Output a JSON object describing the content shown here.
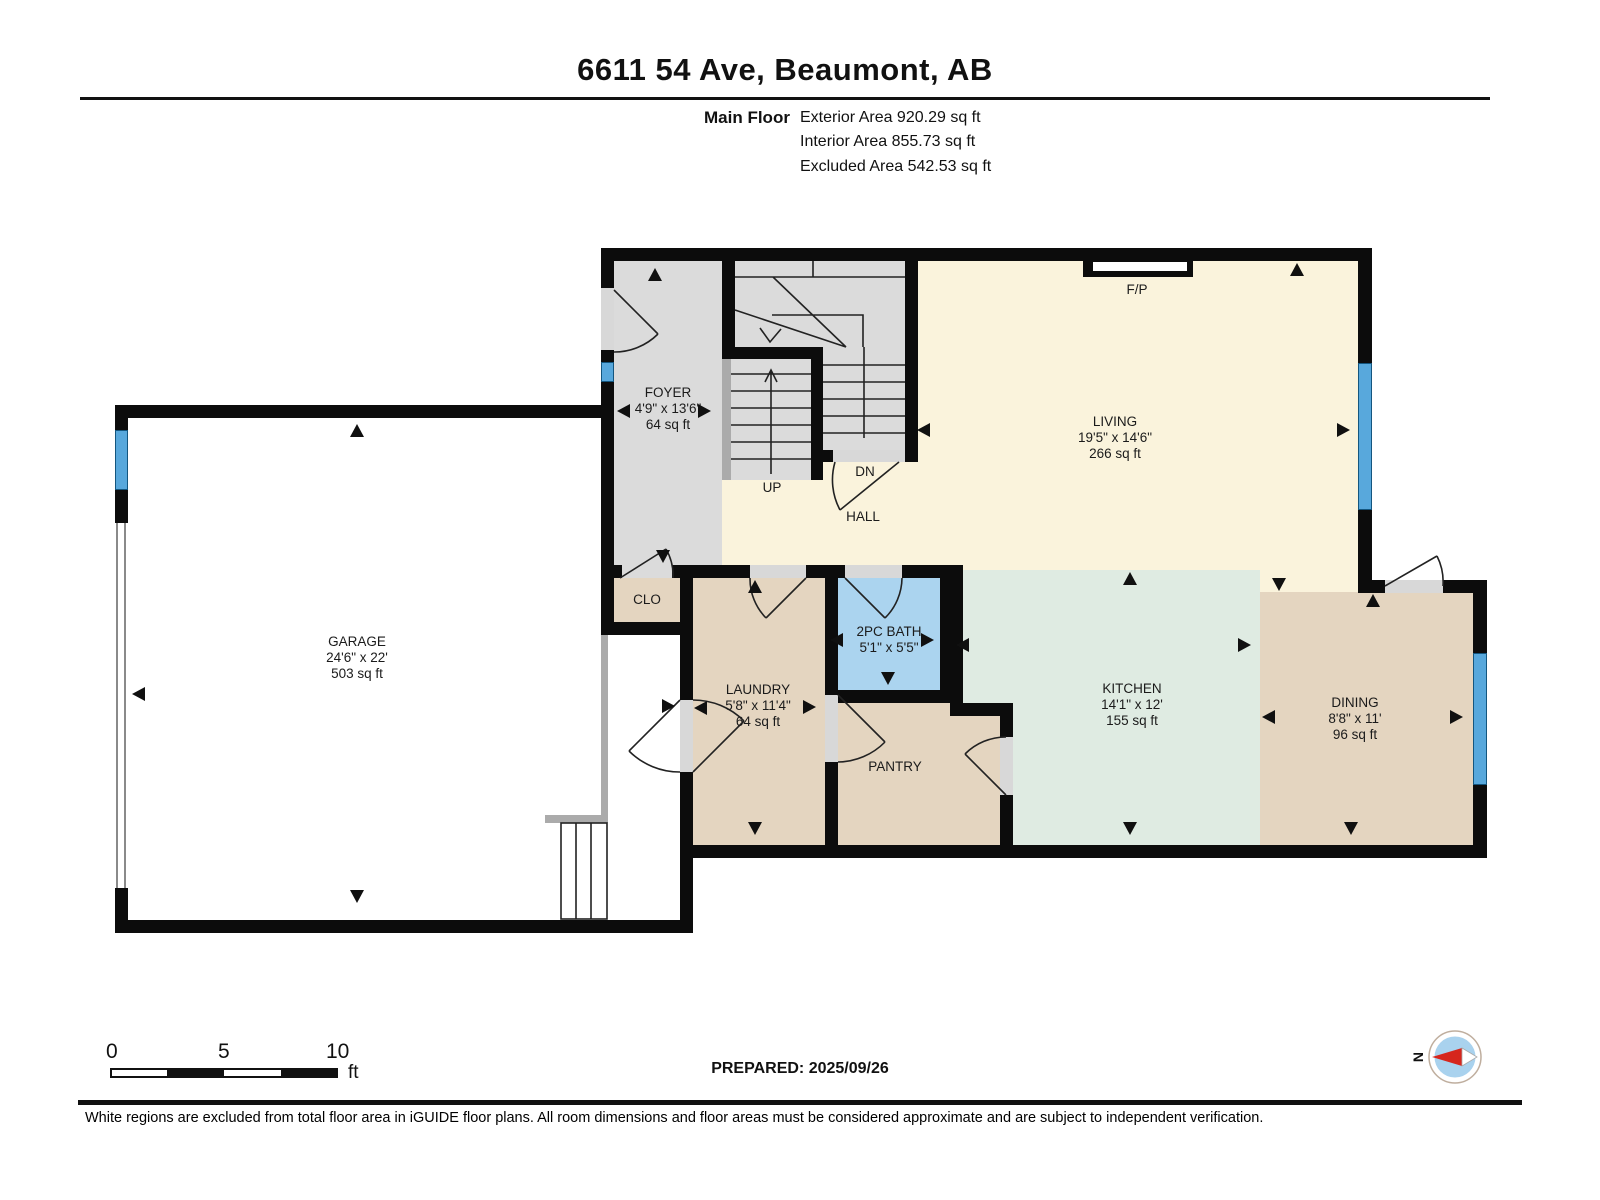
{
  "header": {
    "title": "6611 54 Ave, Beaumont, AB",
    "floor_label": "Main Floor",
    "area_lines": [
      "Exterior Area 920.29 sq ft",
      "Interior Area 855.73 sq ft",
      "Excluded Area 542.53 sq ft"
    ]
  },
  "rooms": {
    "foyer": {
      "name": "FOYER",
      "dims": "4'9\" x 13'6\"",
      "area": "64 sq ft"
    },
    "living": {
      "name": "LIVING",
      "dims": "19'5\" x 14'6\"",
      "area": "266 sq ft"
    },
    "garage": {
      "name": "GARAGE",
      "dims": "24'6\" x 22'",
      "area": "503 sq ft"
    },
    "laundry": {
      "name": "LAUNDRY",
      "dims": "5'8\" x 11'4\"",
      "area": "64 sq ft"
    },
    "bath": {
      "name": "2PC BATH",
      "dims": "5'1\" x 5'5\""
    },
    "kitchen": {
      "name": "KITCHEN",
      "dims": "14'1\" x 12'",
      "area": "155 sq ft"
    },
    "dining": {
      "name": "DINING",
      "dims": "8'8\" x 11'",
      "area": "96 sq ft"
    },
    "pantry": {
      "name": "PANTRY"
    },
    "clo": {
      "name": "CLO"
    },
    "hall": {
      "name": "HALL"
    }
  },
  "stair_labels": {
    "up": "UP",
    "dn": "DN"
  },
  "fireplace_label": "F/P",
  "scale_bar": {
    "ticks": [
      "0",
      "5",
      "10"
    ],
    "unit": "ft"
  },
  "footer": {
    "prepared": "PREPARED: 2025/09/26",
    "compass_label": "N",
    "disclaimer": "White regions are excluded from total floor area in iGUIDE floor plans. All room dimensions and floor areas must be considered approximate and are subject to independent verification."
  },
  "colors": {
    "wall": "#0c0c0c",
    "floor_cream": "#faf3dc",
    "floor_gray": "#dbdbdb",
    "floor_tan": "#e4d5c0",
    "floor_blue": "#abd4ef",
    "floor_mint": "#dfebe2",
    "window_blue": "#58a8dc",
    "threshold_gray": "#d8d8d8",
    "rail_gray": "#ababab",
    "compass_red": "#d6261d",
    "compass_blue": "#a9d2ee"
  }
}
